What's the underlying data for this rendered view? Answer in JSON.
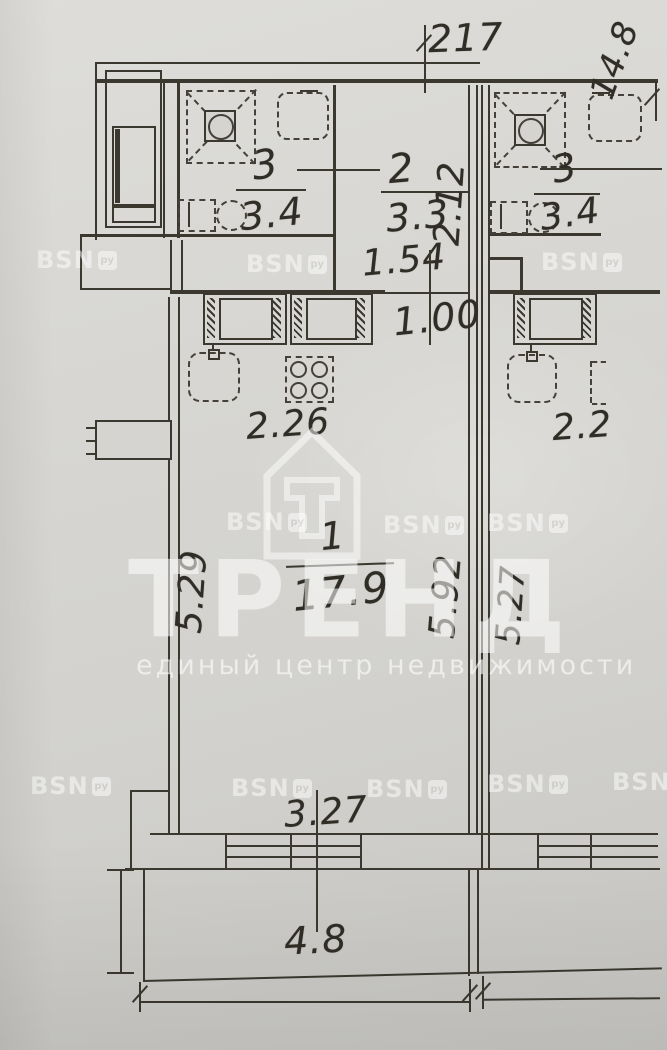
{
  "floorplan": {
    "rooms": [
      {
        "number": "1",
        "area": "17.9",
        "name": "main-room"
      },
      {
        "number": "2",
        "area": "3.3",
        "name": "hall-room"
      },
      {
        "number": "3",
        "area": "3.4",
        "name": "bathroom-left-unit"
      },
      {
        "number": "3",
        "area": "3.4",
        "name": "bathroom-right-unit"
      }
    ],
    "dims": {
      "top_width": "217",
      "building_side": "14.8",
      "room2_height": "2.12",
      "hall_width": "1.54",
      "passage_width": "1.00",
      "kitchen_width": "2.26",
      "kitchen_width_right": "2.2",
      "room1_left_height": "5.29",
      "room1_right_height": "5.92",
      "unit2_left_height": "5.27",
      "window_width": "3.27",
      "balcony_area": "4.8"
    },
    "watermark": {
      "brand": "ТРЕНД",
      "tagline": "единый центр недвижимости",
      "badge_text": "BSN",
      "badge_box": "ру"
    }
  },
  "colors": {
    "paper": "#d7d6d2",
    "ink": "#3b382f",
    "watermark": "#ffffff"
  }
}
